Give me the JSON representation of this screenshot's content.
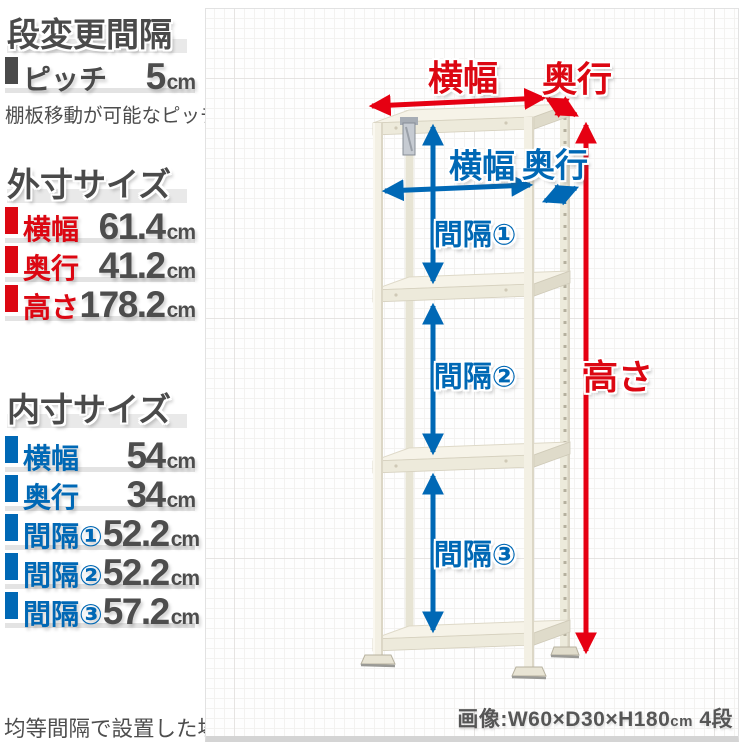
{
  "colors": {
    "red": "#dc0712",
    "blue": "#0068b5",
    "dark": "#4d4d4d"
  },
  "pitch_section": {
    "title": "段変更間隔",
    "rows": [
      {
        "label": "ピッチ",
        "value": "5",
        "unit": "cm"
      }
    ],
    "note": "棚板移動が可能なピッチ"
  },
  "outer_section": {
    "title": "外寸サイズ",
    "rows": [
      {
        "label": "横幅",
        "value": "61.4",
        "unit": "cm"
      },
      {
        "label": "奥行",
        "value": "41.2",
        "unit": "cm"
      },
      {
        "label": "高さ",
        "value": "178.2",
        "unit": "cm"
      }
    ]
  },
  "inner_section": {
    "title": "内寸サイズ",
    "rows": [
      {
        "label": "横幅",
        "value": "54",
        "unit": "cm"
      },
      {
        "label": "奥行",
        "value": "34",
        "unit": "cm"
      },
      {
        "label": "間隔①",
        "value": "52.2",
        "unit": "cm"
      },
      {
        "label": "間隔②",
        "value": "52.2",
        "unit": "cm"
      },
      {
        "label": "間隔③",
        "value": "57.2",
        "unit": "cm"
      }
    ]
  },
  "footnote": "均等間隔で設置した場合",
  "diagram": {
    "outer_width_label": "横幅",
    "outer_depth_label": "奥行",
    "outer_height_label": "高さ",
    "inner_width_label": "横幅",
    "inner_depth_label": "奥行",
    "gap1_label": "間隔①",
    "gap2_label": "間隔②",
    "gap3_label": "間隔③",
    "caption": {
      "prefix": "画像:W60×D30×H180",
      "unit": "cm",
      "suffix": " 4段"
    }
  }
}
